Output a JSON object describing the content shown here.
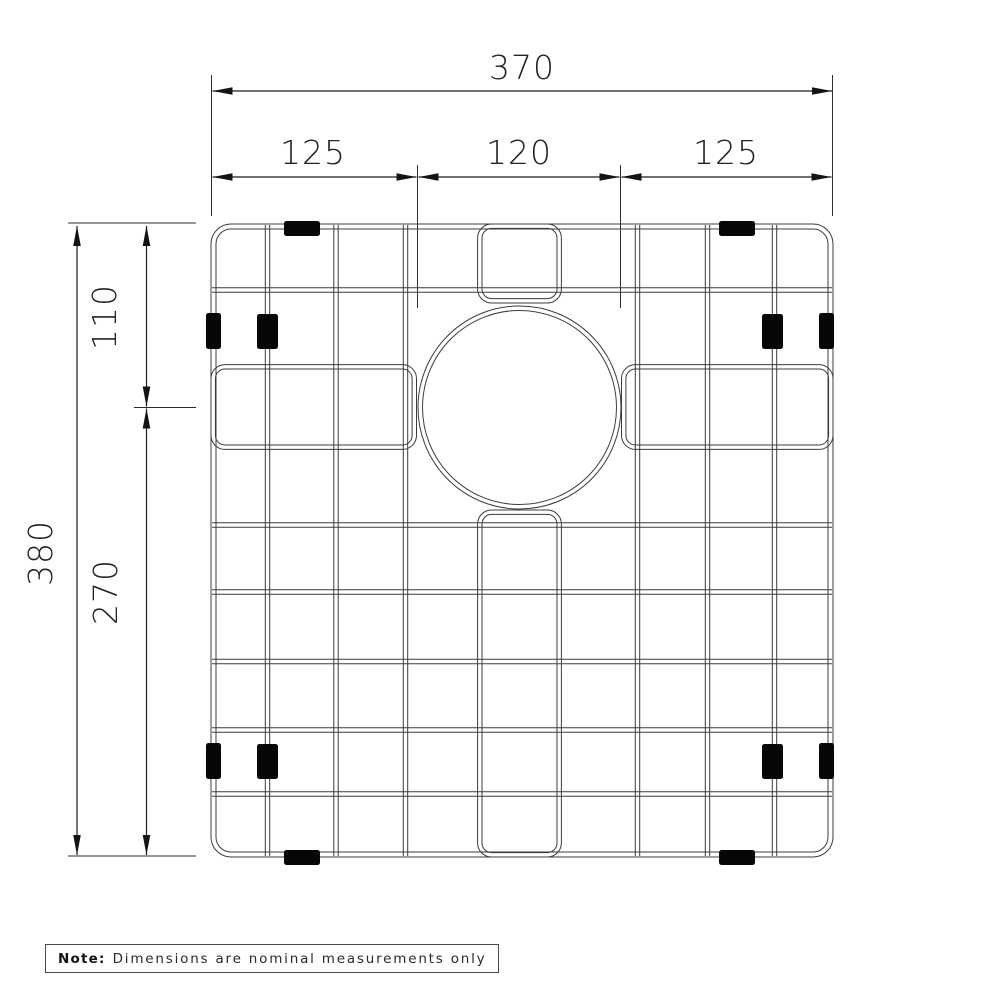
{
  "title": "Sink grid technical drawing",
  "dimensions": {
    "overall_width": "370",
    "segment_left": "125",
    "segment_center": "120",
    "segment_right": "125",
    "overall_height": "380",
    "top_offset": "110",
    "bottom_offset": "270"
  },
  "note": {
    "label": "Note:",
    "text": "Dimensions are nominal measurements only"
  },
  "colors": {
    "background": "#ffffff",
    "line": "#1c1c1c",
    "wire": "#3c3c3c",
    "foot": "#070707"
  },
  "geometry": {
    "wire_gap": 4.4,
    "frame": {
      "x": 211,
      "y": 224,
      "w": 622,
      "h": 633,
      "r": 20,
      "inset": 5
    },
    "v_wires": [
      267.5,
      336,
      405.5,
      637.5,
      707.5,
      774.5
    ],
    "h_wires": [
      290,
      525,
      592,
      661.5,
      730,
      794
    ],
    "pockets": [
      {
        "name": "left-pocket",
        "x": 211,
        "y": 364.6,
        "w": 205.5,
        "h": 84.8,
        "r": 14
      },
      {
        "name": "right-pocket",
        "x": 621.5,
        "y": 364.6,
        "w": 211.5,
        "h": 84.8,
        "r": 14
      },
      {
        "name": "top-pocket",
        "x": 477.6,
        "y": 224,
        "w": 83.8,
        "h": 79,
        "r": 14
      },
      {
        "name": "bottom-pocket",
        "x": 477.6,
        "y": 510,
        "w": 83.8,
        "h": 347,
        "r": 14
      }
    ],
    "hole": {
      "cx": 519.5,
      "cy": 407.5,
      "r_outer": 101.5,
      "r_inner": 97
    },
    "feet": [
      {
        "x": 284,
        "y": 221,
        "w": 36,
        "h": 15
      },
      {
        "x": 719,
        "y": 221,
        "w": 36,
        "h": 15
      },
      {
        "x": 284,
        "y": 850,
        "w": 36,
        "h": 15
      },
      {
        "x": 719,
        "y": 850,
        "w": 36,
        "h": 15
      },
      {
        "x": 206,
        "y": 313,
        "w": 15,
        "h": 36
      },
      {
        "x": 206,
        "y": 743,
        "w": 15,
        "h": 36
      },
      {
        "x": 819,
        "y": 313,
        "w": 15,
        "h": 36
      },
      {
        "x": 819,
        "y": 743,
        "w": 15,
        "h": 36
      },
      {
        "x": 257,
        "y": 314,
        "w": 21,
        "h": 35
      },
      {
        "x": 257,
        "y": 744,
        "w": 21,
        "h": 35
      },
      {
        "x": 762,
        "y": 314,
        "w": 21,
        "h": 35
      },
      {
        "x": 762,
        "y": 744,
        "w": 21,
        "h": 35
      }
    ],
    "dims_h": [
      {
        "x1": 212.5,
        "x2": 832,
        "y": 91
      },
      {
        "x1": 212.5,
        "x2": 416.5,
        "y": 177
      },
      {
        "x1": 418.5,
        "x2": 619.5,
        "y": 177
      },
      {
        "x1": 621.5,
        "x2": 831.5,
        "y": 177
      }
    ],
    "dims_v": [
      {
        "x": 77,
        "y1": 226,
        "y2": 855
      },
      {
        "x": 146.5,
        "y1": 226,
        "y2": 406.5
      },
      {
        "x": 146.5,
        "y1": 408.5,
        "y2": 855
      }
    ],
    "extension_lines": [
      [
        211.5,
        75,
        211.5,
        216
      ],
      [
        832.5,
        75,
        832.5,
        216
      ],
      [
        417.5,
        165,
        417.5,
        308
      ],
      [
        620.5,
        165,
        620.5,
        308
      ],
      [
        68,
        223,
        196,
        223
      ],
      [
        68,
        856,
        196,
        856
      ],
      [
        134,
        407.5,
        196,
        407.5
      ]
    ],
    "arrow": {
      "length": 20,
      "half_width": 3.8
    }
  }
}
